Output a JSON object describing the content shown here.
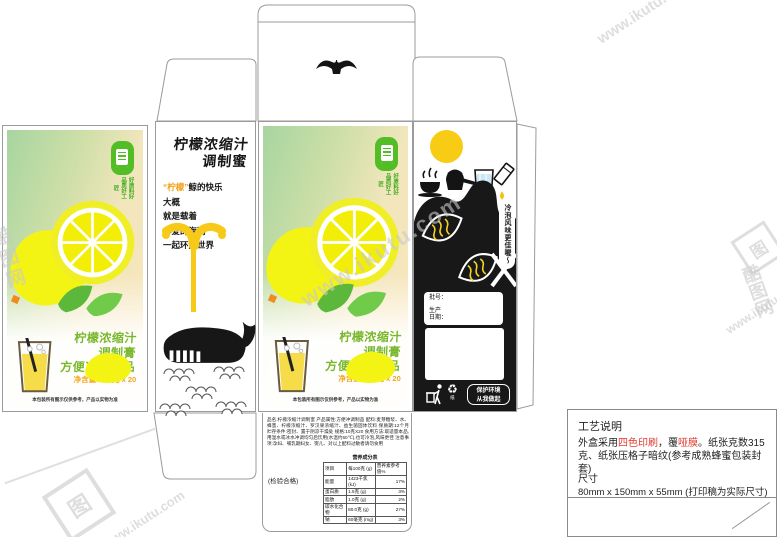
{
  "watermark": {
    "site": "www.ikutu.com",
    "brand": "酷图网",
    "logo_char": "图"
  },
  "lid": {
    "icon": "whale-tail"
  },
  "front": {
    "badge_cols": [
      "好原料",
      "好品质",
      "好工匠"
    ],
    "title_lines": [
      "柠檬浓缩汁",
      "调制膏",
      "方便冲调制品"
    ],
    "net_content": "净含量：10克 x 20",
    "disclaimer": "本包装所有图示仅供参考，产品以实物为准"
  },
  "side": {
    "title_lines": [
      "柠檬浓缩汁",
      "调制蜜"
    ],
    "slogan_hl": "“柠檬”",
    "slogan_rest": "鲸的快乐",
    "lines": [
      "大概",
      "就是载着",
      "心爱的海鸥",
      "一起环游世界"
    ]
  },
  "back": {
    "bubble": "冷泡风味更佳喔～",
    "batch_label": "批号：",
    "prod_label_1": "生产",
    "prod_label_2": "日期：",
    "recycle_glyph": "♻",
    "paper_label": "纸",
    "eco_line1": "保护环境",
    "eco_line2": "从我做起"
  },
  "flap": {
    "fine_print": "品名:柠檬浓缩汁调制蜜 产品属性:方便冲调制品 配料:麦芽糖浆、水、蜂蜜、柠檬浓缩汁、罗汉果浓缩汁、益生菌固体饮料 保质期:12个月 贮存条件:密封、置于阴凉干燥处 规格:10克X20 食用方法:取适量本品,用温水或冰水冲调均匀后饮用(水温约60℃),也可冷泡,风味更佳 注意事项:孕妇、哺乳期妇女、婴儿、对以上配料过敏者请勿食用",
    "inspection": "(检验合格)",
    "nutrition": {
      "title": "营养成分表",
      "headers": [
        "项目",
        "每100克 (g)",
        "营养素参考值%"
      ],
      "rows": [
        [
          "能量",
          "1423千焦 (kJ)",
          "17%"
        ],
        [
          "蛋白质",
          "1.5克 (g)",
          "3%"
        ],
        [
          "脂肪",
          "1.0克 (g)",
          "2%"
        ],
        [
          "碳水化合物",
          "80.0克 (g)",
          "27%"
        ],
        [
          "钠",
          "60毫克 (mg)",
          "3%"
        ]
      ]
    }
  },
  "notes": {
    "title": "工艺说明",
    "p1": "外盒采用",
    "p2": "四色印刷",
    "p3": "，覆",
    "p4": "哑膜",
    "p5": "。纸张克数315克、纸张压格子暗纹(参考成熟蜂蜜包装封套)",
    "size_label": "尺寸",
    "size_value": "80mm x 150mm x 55mm  (打印稿为实际尺寸)"
  },
  "colors": {
    "accent_green": "#79b82c",
    "accent_orange": "#f2a51c",
    "lemon_yellow": "#f4f414",
    "panel_black": "#181818",
    "highlight_red": "#e03a2f"
  }
}
